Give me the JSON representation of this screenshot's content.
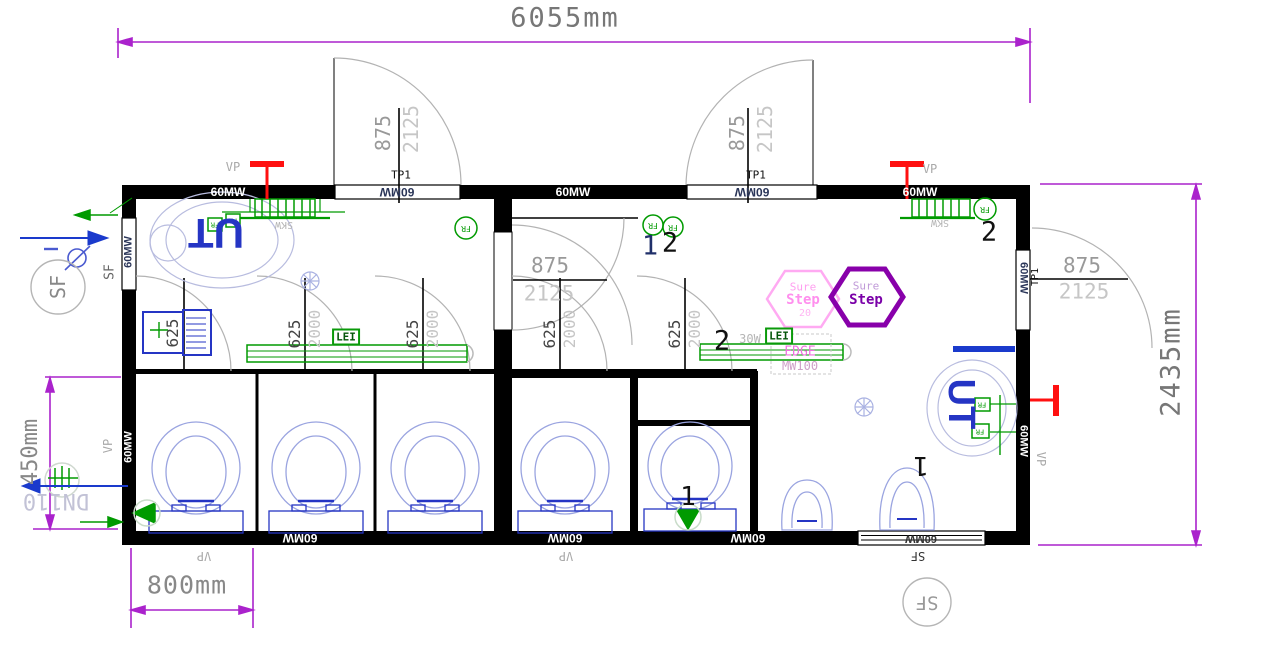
{
  "drawing": {
    "type": "CAD floor plan - sanitary container unit",
    "dimensions": {
      "overall_width": "6055mm",
      "overall_depth": "2435mm",
      "stall_pitch": "800mm",
      "rear_offset": "450mm",
      "drain_pipe": "DN110",
      "exterior_door_width": "875",
      "exterior_door_height": "2125",
      "stall_door_width": "625",
      "stall_door_height": "2000"
    },
    "labels": {
      "wall_panel": "60MW",
      "vp": "VP",
      "sf": "SF",
      "skw": "SKW",
      "lei": "LEI",
      "fr": "FR",
      "ut": "UT",
      "door_type": "TP1",
      "heater_watt": "30W",
      "num1": "1",
      "num2": "2",
      "edge_line1": "EDGE",
      "edge_line2": "MW100"
    },
    "logo": {
      "word1": "Sure",
      "word2": "Step",
      "number": "20"
    },
    "colors": {
      "dimension_magenta": "#aa22cc",
      "wall_black": "#000000",
      "fixture_blue": "#2535c4",
      "fixture_light": "#9aa4e0",
      "equipment_green": "#009a00",
      "heater_red": "#ff1010",
      "logo_pink": "#ffaaf2",
      "logo_purple": "#8800aa"
    }
  }
}
